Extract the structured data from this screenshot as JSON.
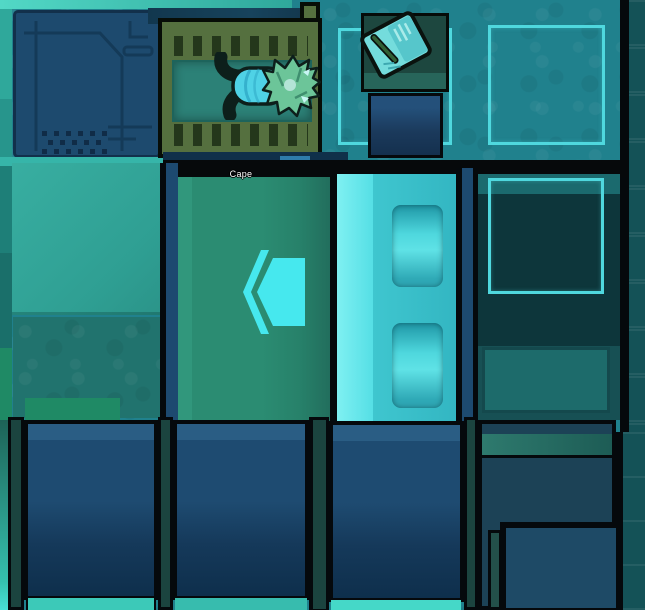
{
  "pawn": {
    "name_label": "Cape"
  },
  "icons": {
    "chevron_marker": "double-chevron-left",
    "book_item": "open-journal",
    "circuit_panel": "tech-circuit-lines"
  },
  "palette": {
    "floor": "#20818d",
    "zone_outline": "#4fd8de",
    "door": "#3fc6cf",
    "door_highlight": "#7ff0f2",
    "room_green": "#2b8c72",
    "bed_frame": "#55703f",
    "mattress": "#2c8177",
    "wall_navy": "#1d4a70",
    "accent_cyan": "#46e8ee",
    "strip_teal": "#36b5a9",
    "outline_black": "#06090b"
  }
}
